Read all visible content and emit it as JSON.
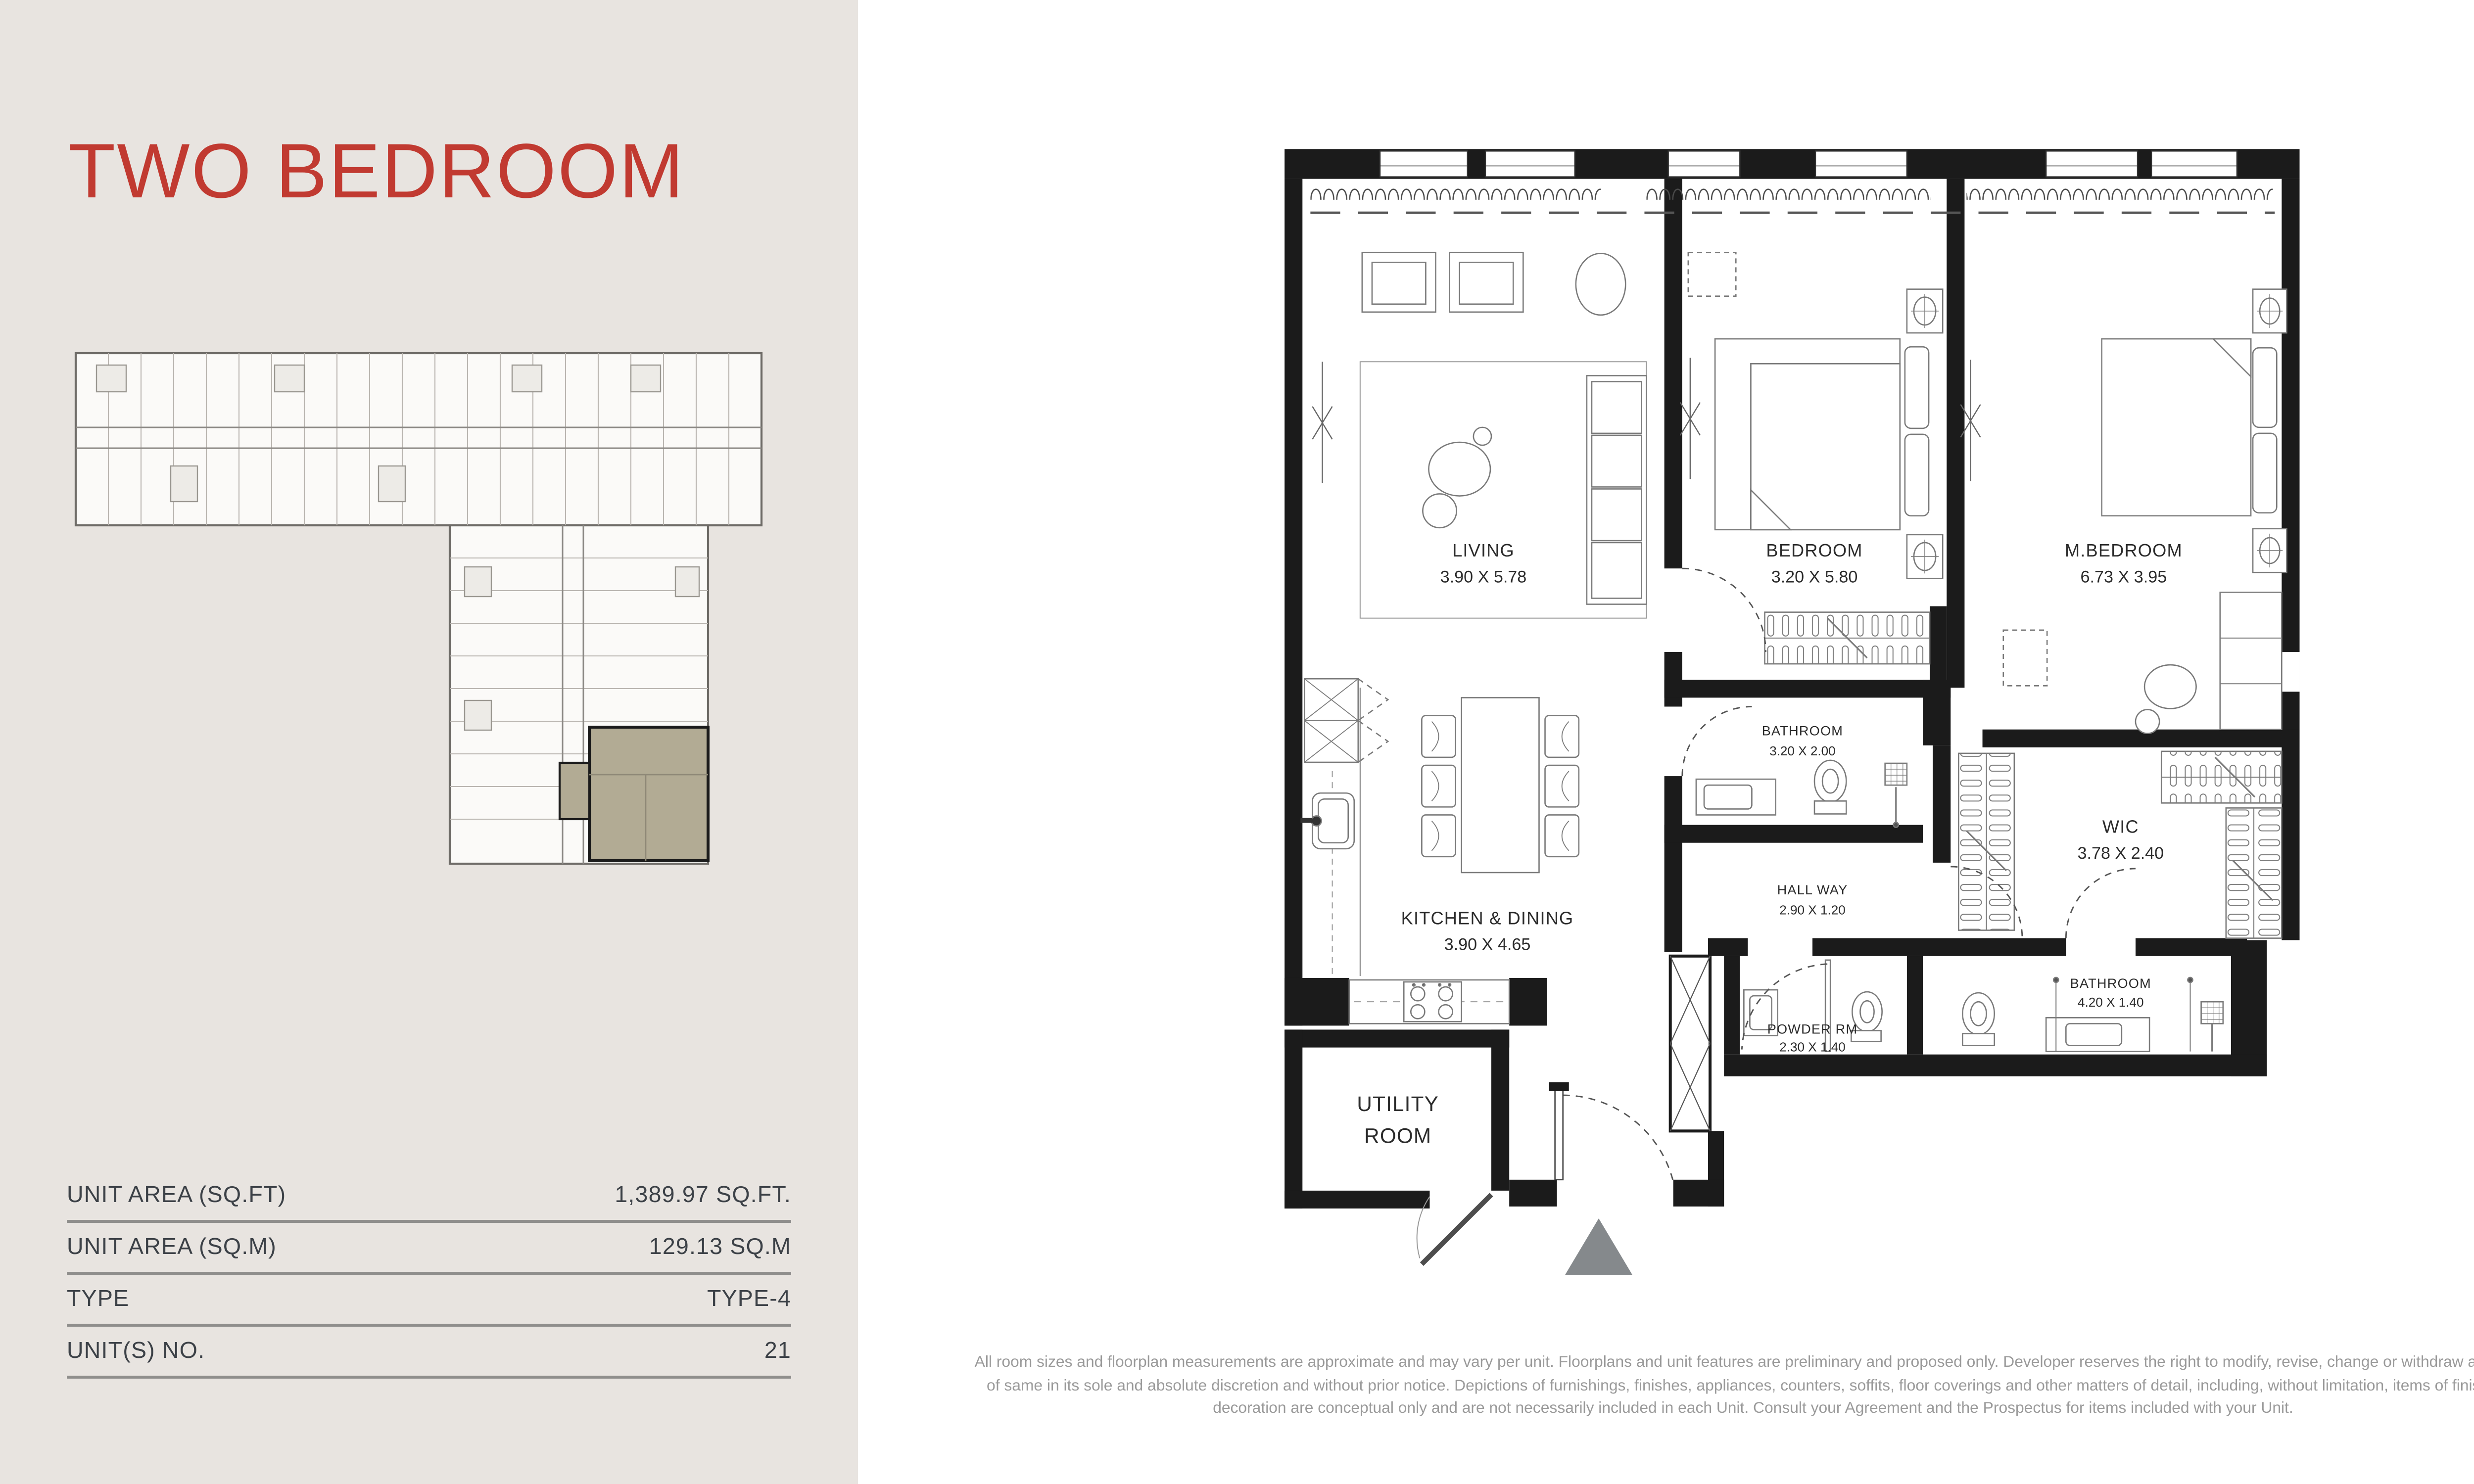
{
  "colors": {
    "left_background": "#e8e4e0",
    "accent_red": "#c13a31",
    "wall_black": "#1b1b1b",
    "table_text": "#3c4147",
    "divider_grey": "#8f8e8c",
    "disclaimer_grey": "#9a9a9a",
    "unit_highlight_tan": "#b2ab94",
    "entry_triangle_grey": "#85898c"
  },
  "left_panel": {
    "title": "TWO BEDROOM",
    "details": [
      {
        "label": "UNIT AREA (SQ.FT)",
        "value": "1,389.97 SQ.FT."
      },
      {
        "label": "UNIT AREA (SQ.M)",
        "value": "129.13 SQ.M"
      },
      {
        "label": "TYPE",
        "value": "TYPE-4"
      },
      {
        "label": "UNIT(S) NO.",
        "value": "21"
      }
    ]
  },
  "floor_plan": {
    "rooms": [
      {
        "id": "living",
        "name": "LIVING",
        "dims": "3.90 X 5.78"
      },
      {
        "id": "bedroom",
        "name": "BEDROOM",
        "dims": "3.20 X 5.80"
      },
      {
        "id": "master-bedroom",
        "name": "M.BEDROOM",
        "dims": "6.73 X 3.95"
      },
      {
        "id": "bathroom-1",
        "name": "BATHROOM",
        "dims": "3.20 X 2.00"
      },
      {
        "id": "kitchen-dining",
        "name": "KITCHEN & DINING",
        "dims": "3.90 X 4.65"
      },
      {
        "id": "hallway",
        "name": "HALL WAY",
        "dims": "2.90 X 1.20"
      },
      {
        "id": "wic",
        "name": "WIC",
        "dims": "3.78 X 2.40"
      },
      {
        "id": "bathroom-2",
        "name": "BATHROOM",
        "dims": "4.20 X 1.40"
      },
      {
        "id": "powder-room",
        "name": "POWDER RM",
        "dims": "2.30 X 1.40"
      },
      {
        "id": "utility-room",
        "line1": "UTILITY",
        "line2": "ROOM"
      }
    ]
  },
  "disclaimer": {
    "lines": [
      "All room sizes and floorplan measurements are approximate and may vary per unit. Floorplans and unit features are preliminary and proposed only. Developer reserves the right to modify, revise, change or withdraw any or all",
      "of same in its sole and absolute discretion and without prior notice. Depictions of furnishings, finishes, appliances, counters, soffits, floor coverings and other matters of detail, including, without limitation, items of finish and",
      "decoration are conceptual only and are not necessarily included in each Unit. Consult your Agreement and the Prospectus for items included with your Unit."
    ]
  }
}
